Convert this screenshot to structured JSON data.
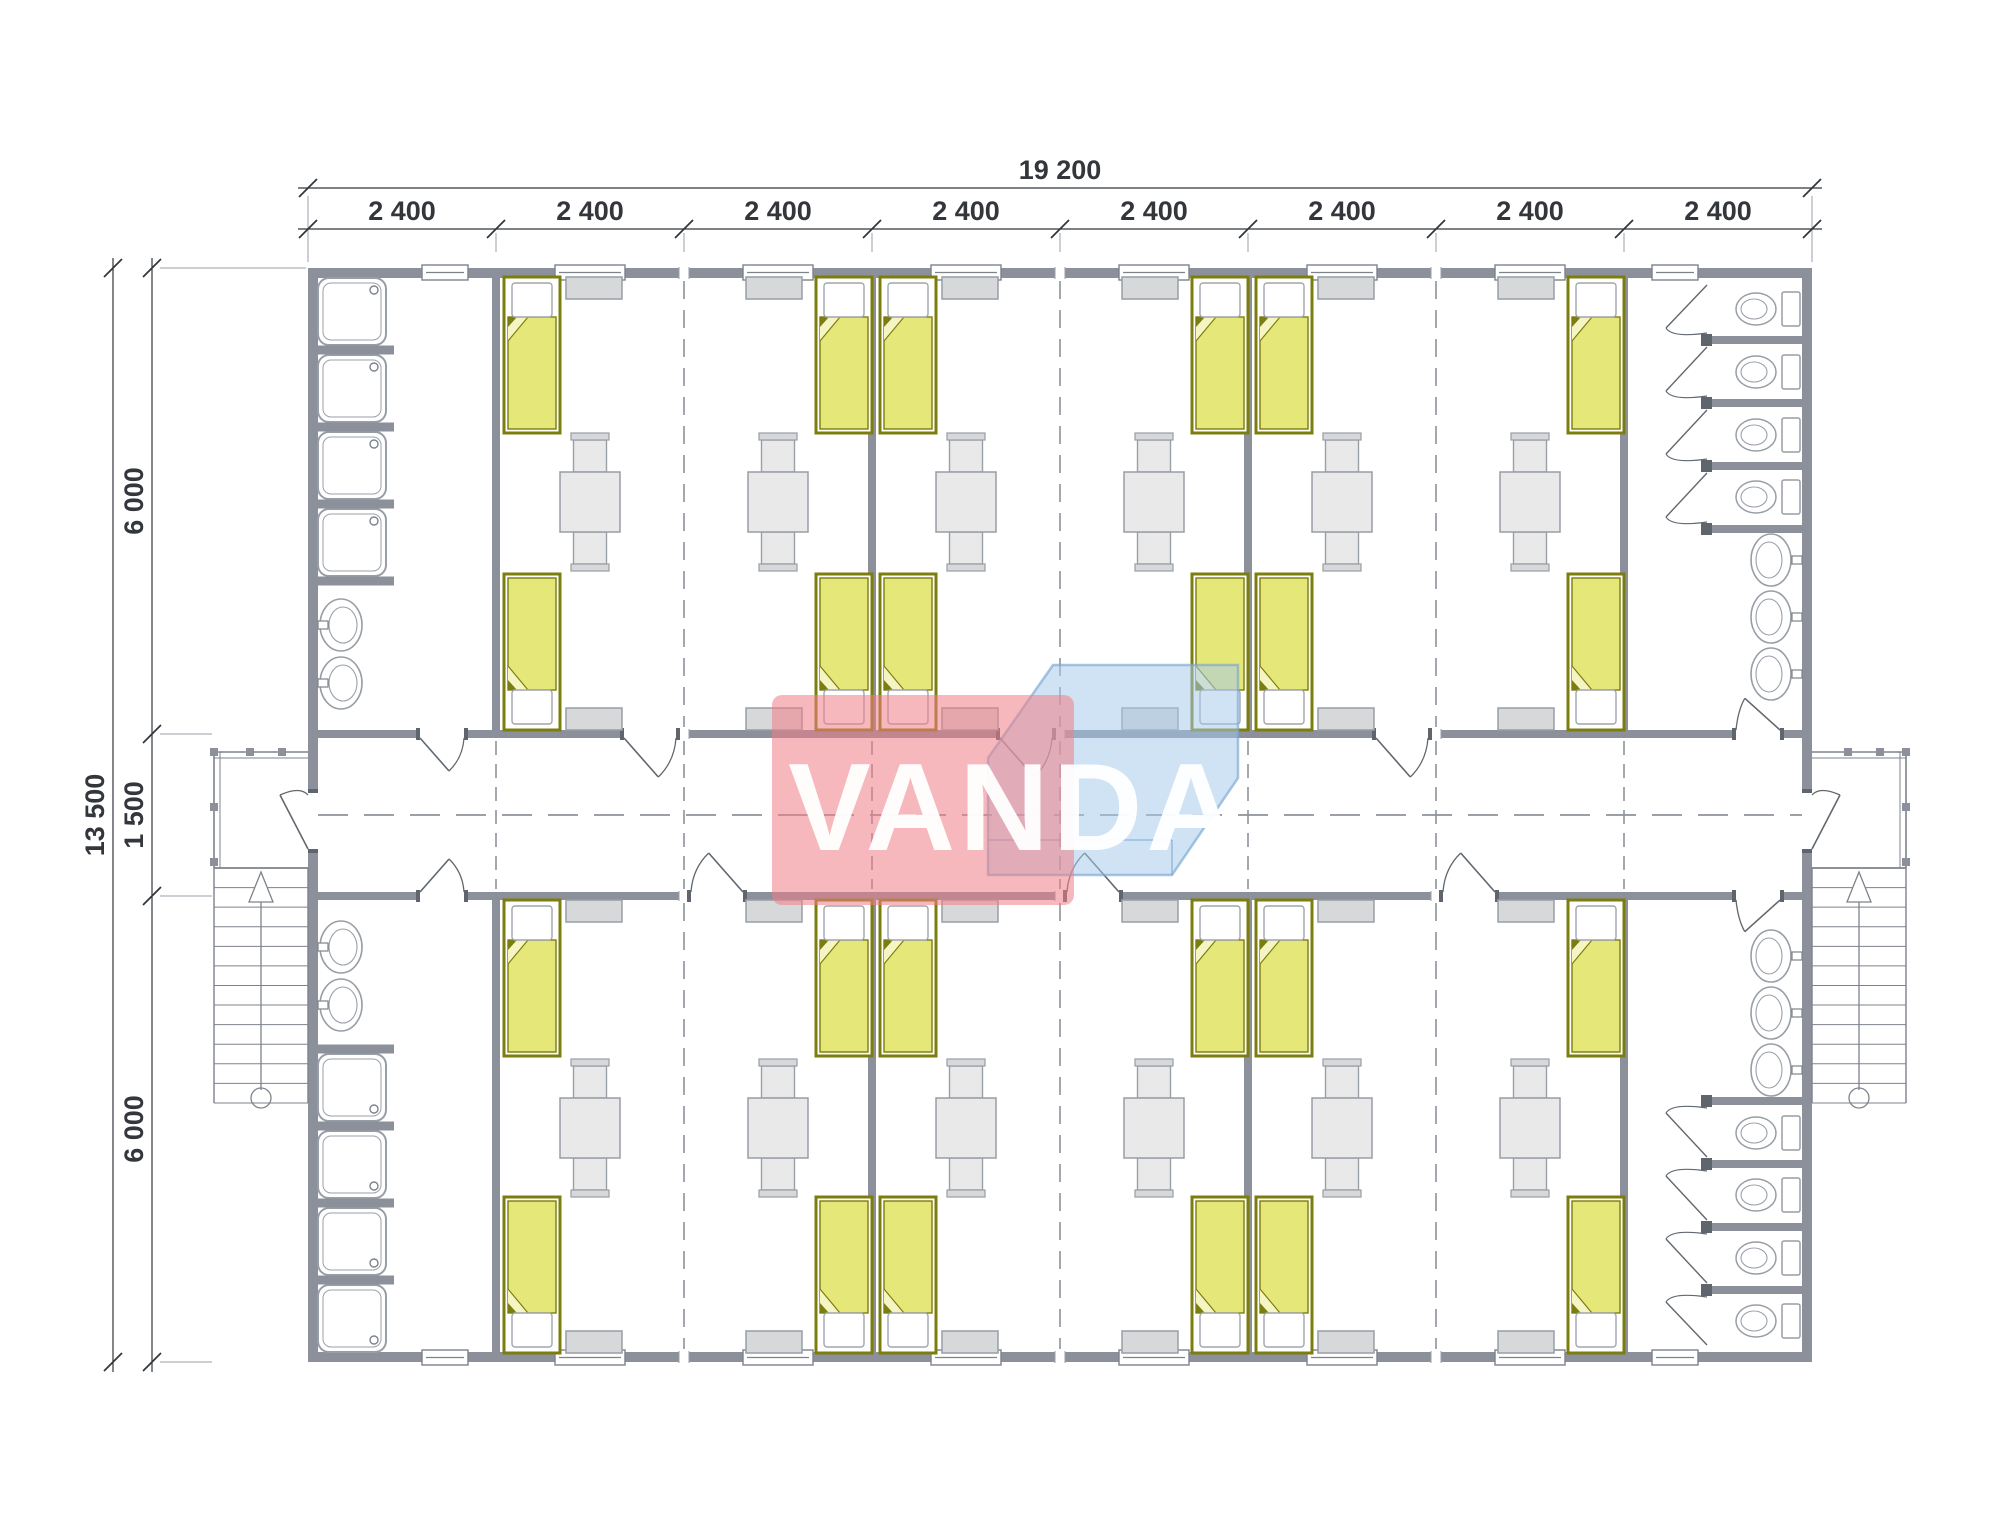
{
  "canvas": {
    "width": 2000,
    "height": 1539,
    "background": "#ffffff"
  },
  "drawing": {
    "type": "architectural-floor-plan",
    "watermark": {
      "text": "VANDA"
    },
    "dimensions": {
      "top_total_label": "19 200",
      "top_segment_label": "2 400",
      "top_segment_count": 8,
      "left_total_label": "13 500",
      "left_segment_labels": [
        "6 000",
        "1 500",
        "6 000"
      ]
    },
    "layout_summary": {
      "bands": 2,
      "modules_per_band": 8,
      "corridor": true,
      "entry_porches": 2,
      "external_stairs": 2,
      "rooms_per_band": [
        {
          "type": "washroom",
          "modules": 1,
          "showers": 4,
          "wash_basins": 2,
          "windows": 1,
          "doors": 1
        },
        {
          "type": "bedroom",
          "modules": 2,
          "beds": 4,
          "tables": 2,
          "chairs_per_table": 2,
          "cabinets": 4,
          "windows": 2,
          "doors": 1
        },
        {
          "type": "bedroom",
          "modules": 2,
          "beds": 4,
          "tables": 2,
          "chairs_per_table": 2,
          "cabinets": 4,
          "windows": 2,
          "doors": 1
        },
        {
          "type": "bedroom",
          "modules": 2,
          "beds": 4,
          "tables": 2,
          "chairs_per_table": 2,
          "cabinets": 4,
          "windows": 2,
          "doors": 1
        },
        {
          "type": "toilet-room",
          "modules": 1,
          "toilets": 4,
          "wash_basins": 3,
          "windows": 1,
          "doors": 1
        }
      ]
    },
    "colors": {
      "wall": "#8b909b",
      "wall_dark": "#5f656d",
      "line": "#7d838b",
      "line_light": "#9aa0a8",
      "furn_fill": "#e9e9e9",
      "furn_fill2": "#d7d8da",
      "furn_stroke": "#989ea6",
      "bed_border": "#7c7d0f",
      "bed_fill": "#e6e779",
      "bed_fold": "#f4f5c2",
      "pillow_stroke": "#a0a6ae",
      "dash": "#8d939b",
      "dim": "#33373c",
      "wm_pink": "rgba(240,125,135,0.55)",
      "wm_blue": "rgba(164,202,233,0.52)",
      "wm_blue_stroke": "rgba(120,168,210,0.65)",
      "wm_text": "rgba(255,255,255,0.95)"
    }
  }
}
